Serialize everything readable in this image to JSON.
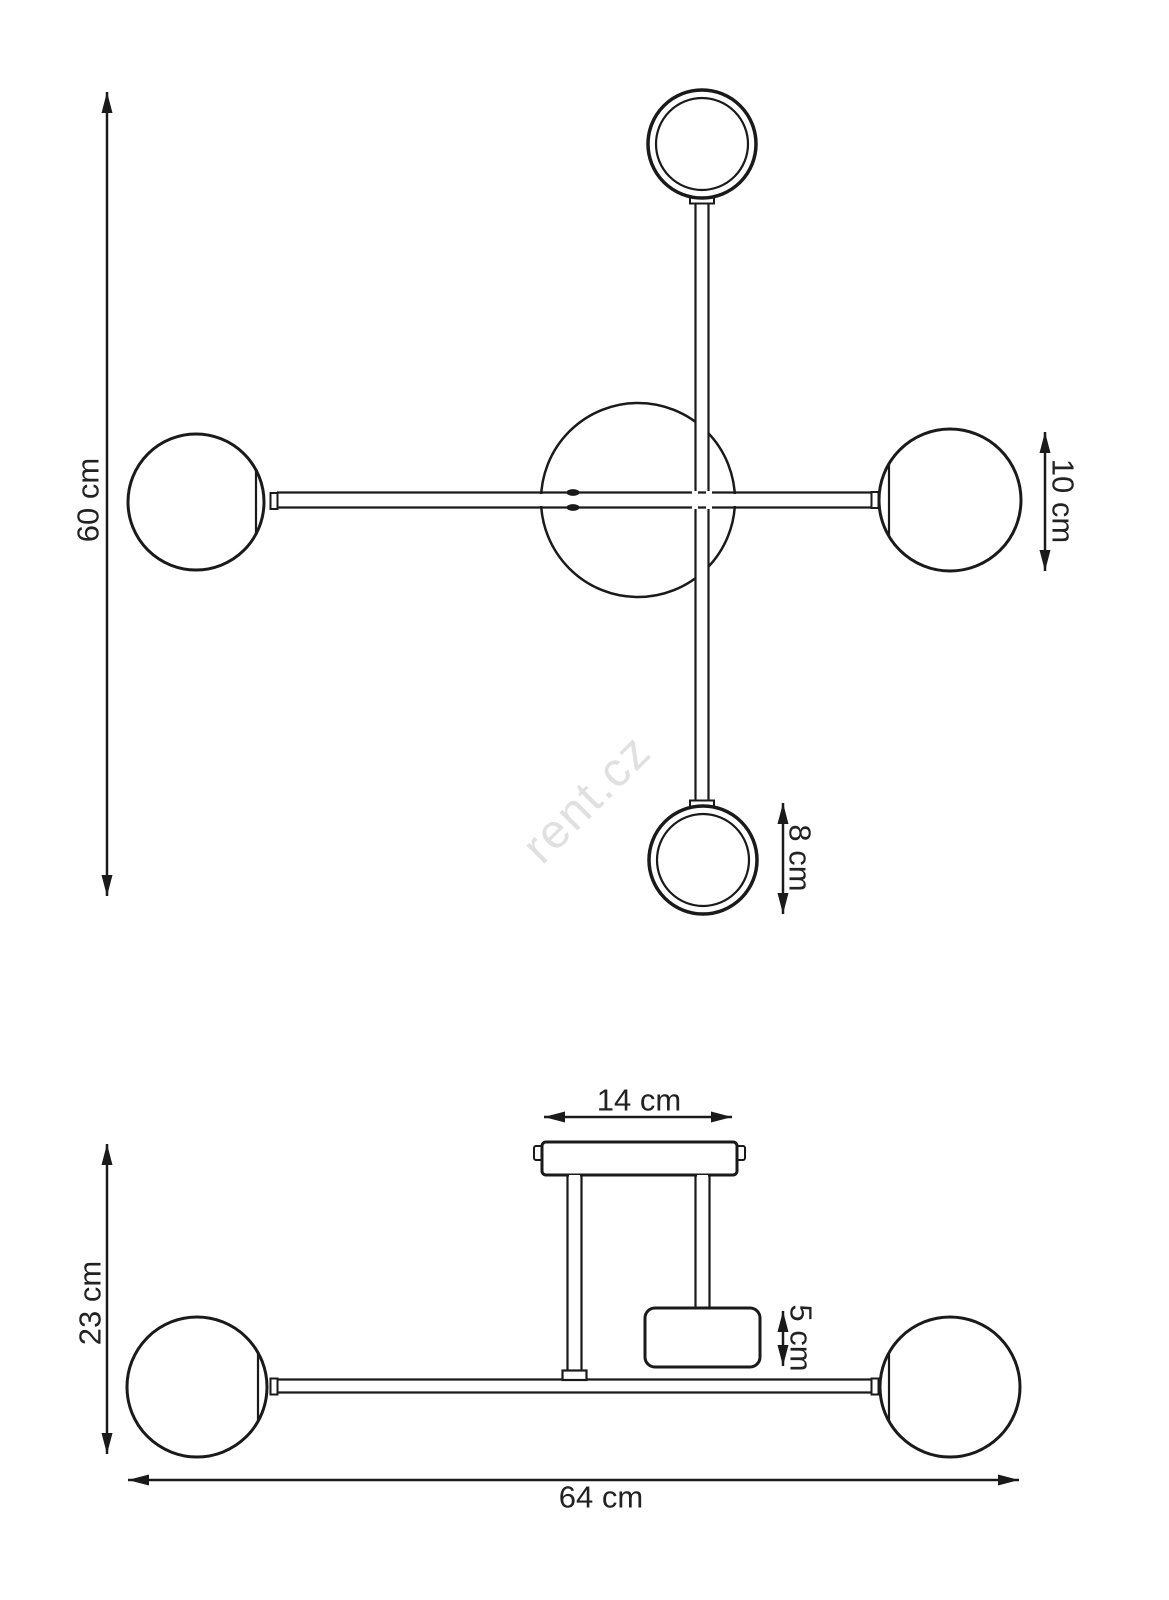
{
  "colors": {
    "line": "#1a1a1a",
    "label": "#222222",
    "watermark": "#e0e0e0",
    "background": "#ffffff"
  },
  "watermark": {
    "text": "rent.cz"
  },
  "top_view": {
    "overall_height": "60 cm",
    "globe_diameter": "10 cm",
    "ring_diameter": "8 cm"
  },
  "side_view": {
    "canopy_width": "14 cm",
    "fixture_height": "23 cm",
    "holder_height": "5 cm",
    "overall_width": "64 cm"
  }
}
